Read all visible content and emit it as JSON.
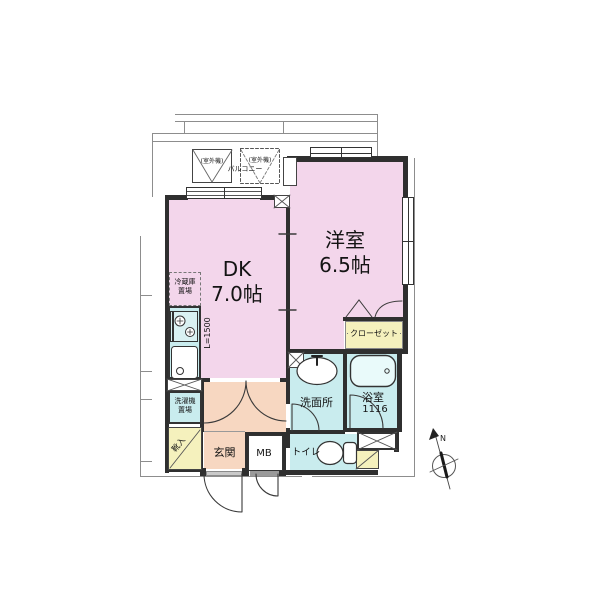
{
  "rooms": {
    "western_room": {
      "name": "洋室",
      "size": "6.5帖"
    },
    "dk": {
      "name": "DK",
      "size": "7.0帖"
    },
    "entrance": {
      "name": "玄関"
    },
    "washroom": {
      "name": "洗面所"
    },
    "bathroom": {
      "name": "浴室",
      "size": "1116"
    },
    "toilet": {
      "name": "トイレ"
    },
    "closet": {
      "name": "クローゼット"
    },
    "meter_box": {
      "name": "MB"
    },
    "shoe_cabinet": {
      "name": "靴入"
    },
    "washer_space": {
      "line1": "洗濯機",
      "line2": "置場"
    },
    "fridge_space": {
      "line1": "冷蔵庫",
      "line2": "置場"
    },
    "balcony": {
      "name": "バルコニー"
    },
    "outdoor_unit": {
      "name": "(室外機)"
    }
  },
  "kitchen": {
    "counter_label": "L=1500"
  },
  "compass": {
    "north": "N"
  },
  "colors": {
    "room_pink": "#f3d6eb",
    "wet_area_cyan": "#c9ecee",
    "hall_peach": "#f7d7c1",
    "storage_yellow": "#f5f1bd",
    "wall": "#2f2f2f"
  }
}
